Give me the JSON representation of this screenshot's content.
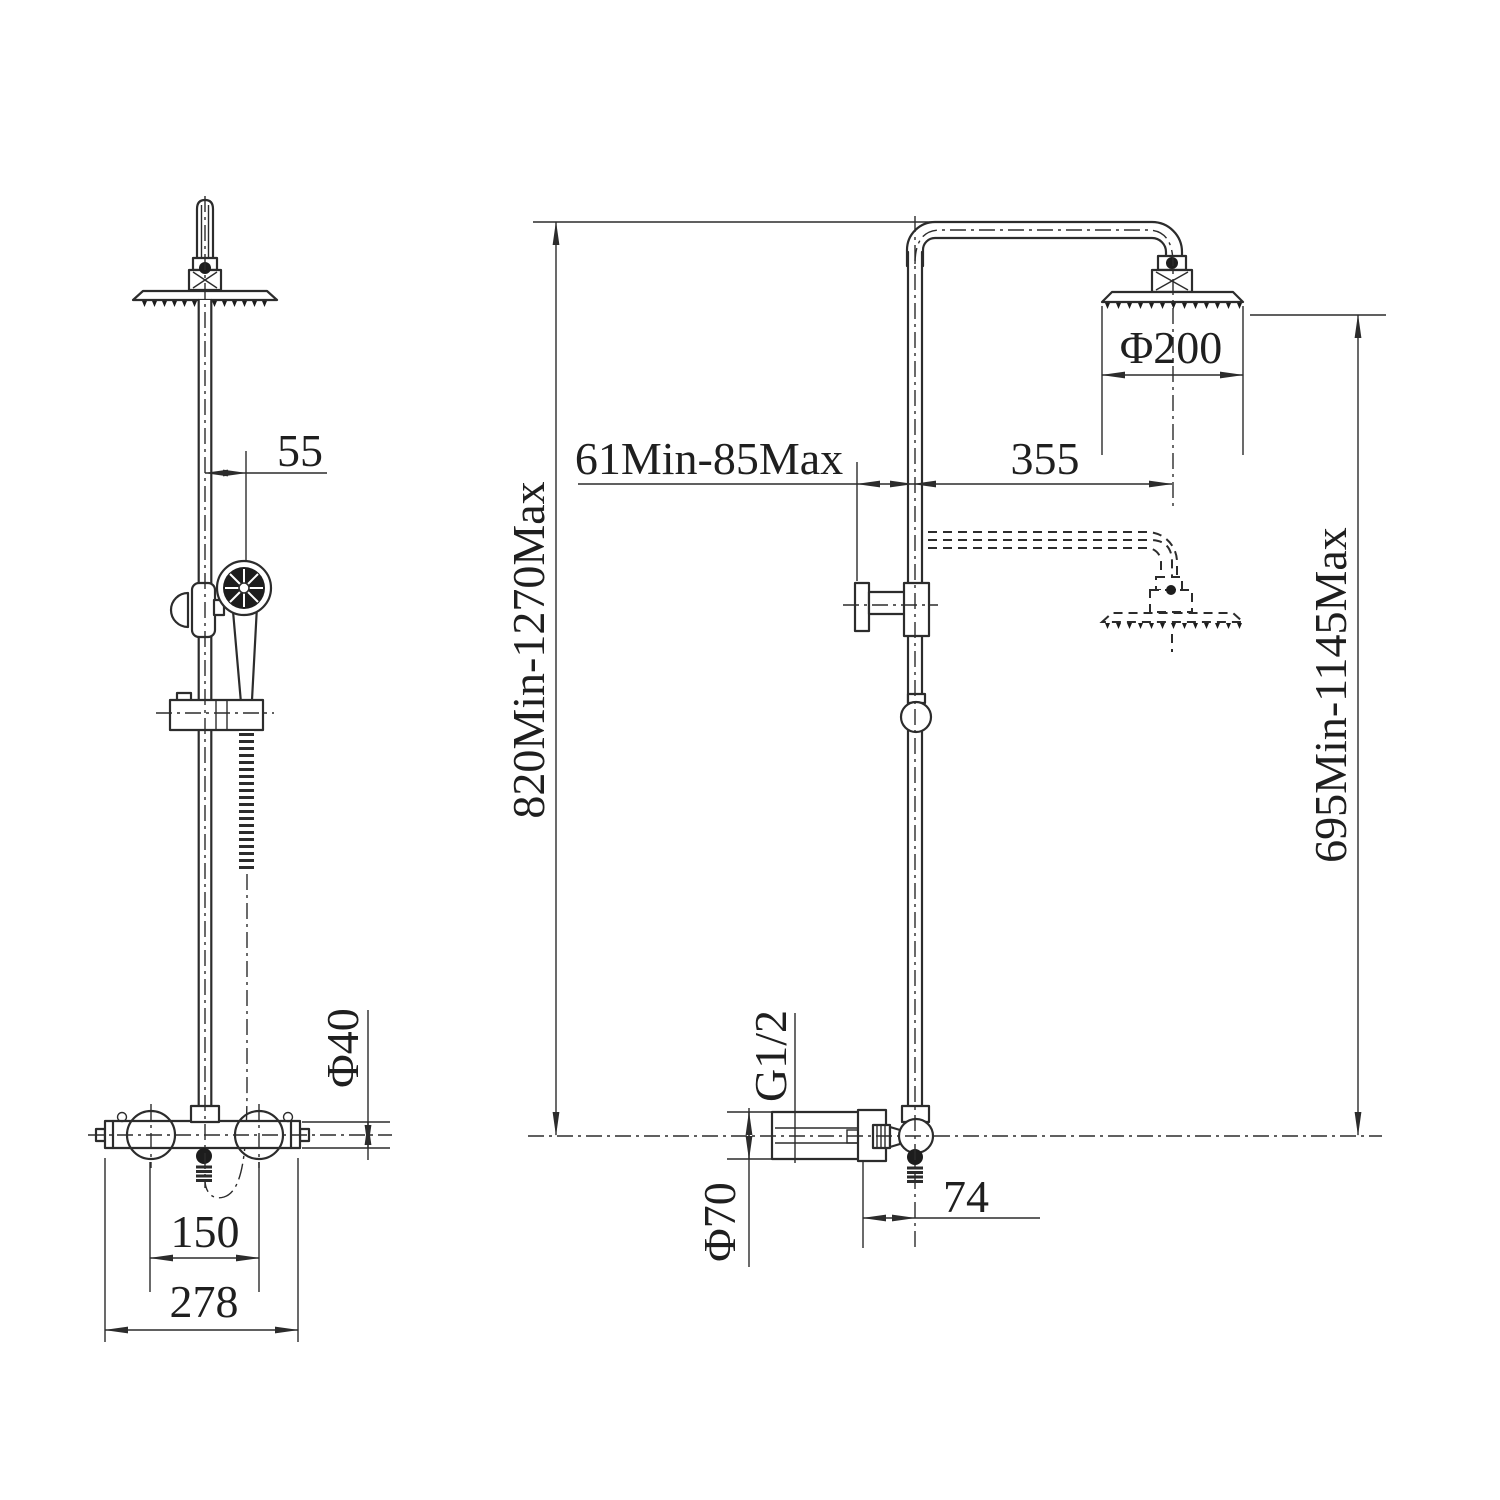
{
  "drawing": {
    "background_color": "#ffffff",
    "line_color": "#2c2c2c",
    "subject": "shower-column-dimension-drawing",
    "views": {
      "front": {
        "label": "front-view",
        "dims": {
          "hand_shower_offset": "55",
          "valve_body_diameter": "Φ40",
          "inlet_center_spacing": "150",
          "valve_overall_width": "278"
        }
      },
      "side": {
        "label": "side-view",
        "dims": {
          "overall_height_range": "820Min-1270Max",
          "wall_clearance_range": "61Min-85Max",
          "arm_projection": "355",
          "head_diameter": "Φ200",
          "head_height_range": "695Min-1145Max",
          "connection_thread": "G1/2",
          "valve_diameter": "Φ70",
          "outlet_offset": "74"
        }
      }
    }
  }
}
